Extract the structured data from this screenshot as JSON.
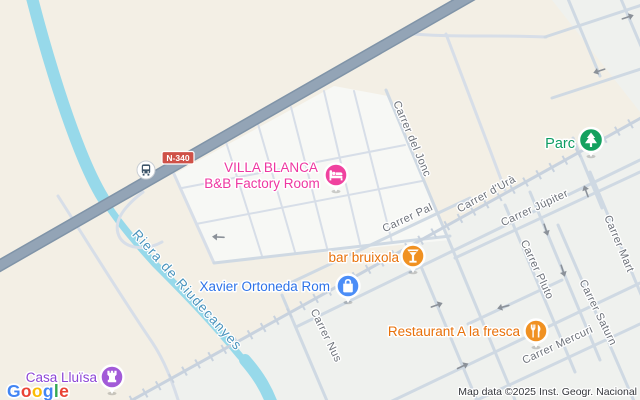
{
  "attribution": {
    "text": "Map data ©2025 Inst. Geogr. Nacional"
  },
  "logo": {
    "letters": [
      {
        "ch": "G",
        "color": "#4285F4"
      },
      {
        "ch": "o",
        "color": "#EA4335"
      },
      {
        "ch": "o",
        "color": "#FBBC05"
      },
      {
        "ch": "g",
        "color": "#4285F4"
      },
      {
        "ch": "l",
        "color": "#34A853"
      },
      {
        "ch": "e",
        "color": "#EA4335"
      }
    ]
  },
  "road_badge": {
    "label": "N-340"
  },
  "water": {
    "label": "Riera de Riudecanyes"
  },
  "streets": [
    {
      "name": "Carrer del Jonc"
    },
    {
      "name": "Carrer Pal"
    },
    {
      "name": "Carrer d'Urà"
    },
    {
      "name": "Carrer Júpiter"
    },
    {
      "name": "Carrer Mart"
    },
    {
      "name": "Carrer Pluto"
    },
    {
      "name": "Carrer Saturn"
    },
    {
      "name": "Carrer Mercuri"
    },
    {
      "name": "Carrer Nus"
    }
  ],
  "pois": [
    {
      "name": "VILLA BLANCA",
      "line2": "B&B Factory Room",
      "category": "lodging",
      "icon": "bed-icon"
    },
    {
      "name": "Parc",
      "category": "park",
      "icon": "tree-icon"
    },
    {
      "name": "bar bruixola",
      "category": "bar",
      "icon": "cocktail-icon"
    },
    {
      "name": "Xavier Ortoneda Rom",
      "category": "shopping",
      "icon": "shopping-bag-icon"
    },
    {
      "name": "Restaurant A la fresca",
      "category": "restaurant",
      "icon": "fork-knife-icon"
    },
    {
      "name": "Casa Lluïsa",
      "category": "historic",
      "icon": "castle-icon"
    }
  ],
  "transit": {
    "icon": "bus-icon"
  },
  "colors": {
    "land": "#f3efe5",
    "urban": "#eff1ee",
    "block": "#f7f8f5",
    "water": "#97d9ea",
    "water_label": "#4a94bd",
    "road": "#cfd9e3",
    "road_fine": "#d7dee8",
    "railway": "#c8d2de",
    "highway": "#93a4b6",
    "highway_casing": "#8094a8",
    "arrow": "#8b9199",
    "street_label": "#6d727a",
    "badge": "#cf5148",
    "lodging_text": "#ee37a1",
    "lodging_pin": "#f0429f",
    "park_text": "#0e9d63",
    "park_pin": "#14a15f",
    "food_text": "#e8710a",
    "food_pin": "#f09122",
    "shop_text": "#2e73e8",
    "shop_pin": "#4b8df7",
    "historic_text": "#8d45d6",
    "historic_pin": "#a25ad8",
    "bus_glyph": "#3f566b"
  }
}
